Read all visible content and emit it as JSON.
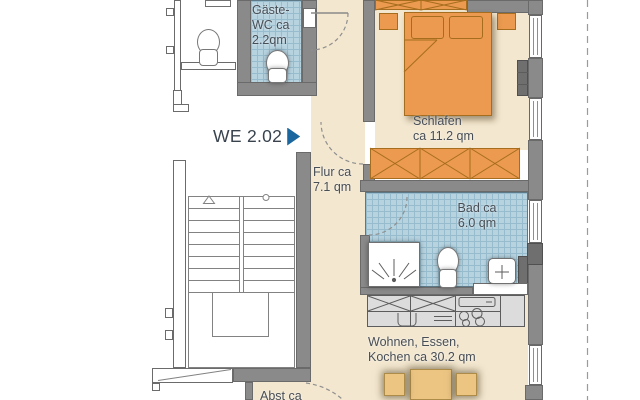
{
  "unit": {
    "label": "WE 2.02"
  },
  "rooms": {
    "gaeste_wc": {
      "line1": "Gäste-",
      "line2": "WC ca",
      "line3": "2.2qm"
    },
    "flur": {
      "line1": "Flur ca",
      "line2": "7.1 qm"
    },
    "schlafen": {
      "line1": "Schlafen",
      "line2": "ca 11.2 qm"
    },
    "bad": {
      "line1": "Bad ca",
      "line2": "6.0 qm"
    },
    "wohnen": {
      "line1": "Wohnen, Essen,",
      "line2": "Kochen ca 30.2 qm"
    },
    "abstell": {
      "line1": "Abst ca"
    }
  },
  "colors": {
    "floor_beige": "#f3e7cf",
    "tile_blue": "#b7d3e0",
    "wall_gray": "#8a8a8a",
    "furniture_orange": "#eb9a4f",
    "furniture_tan": "#ecc583",
    "counter_gray": "#dcdcdc",
    "label_text": "#484e56",
    "unit_arrow_blue": "#19679e"
  }
}
